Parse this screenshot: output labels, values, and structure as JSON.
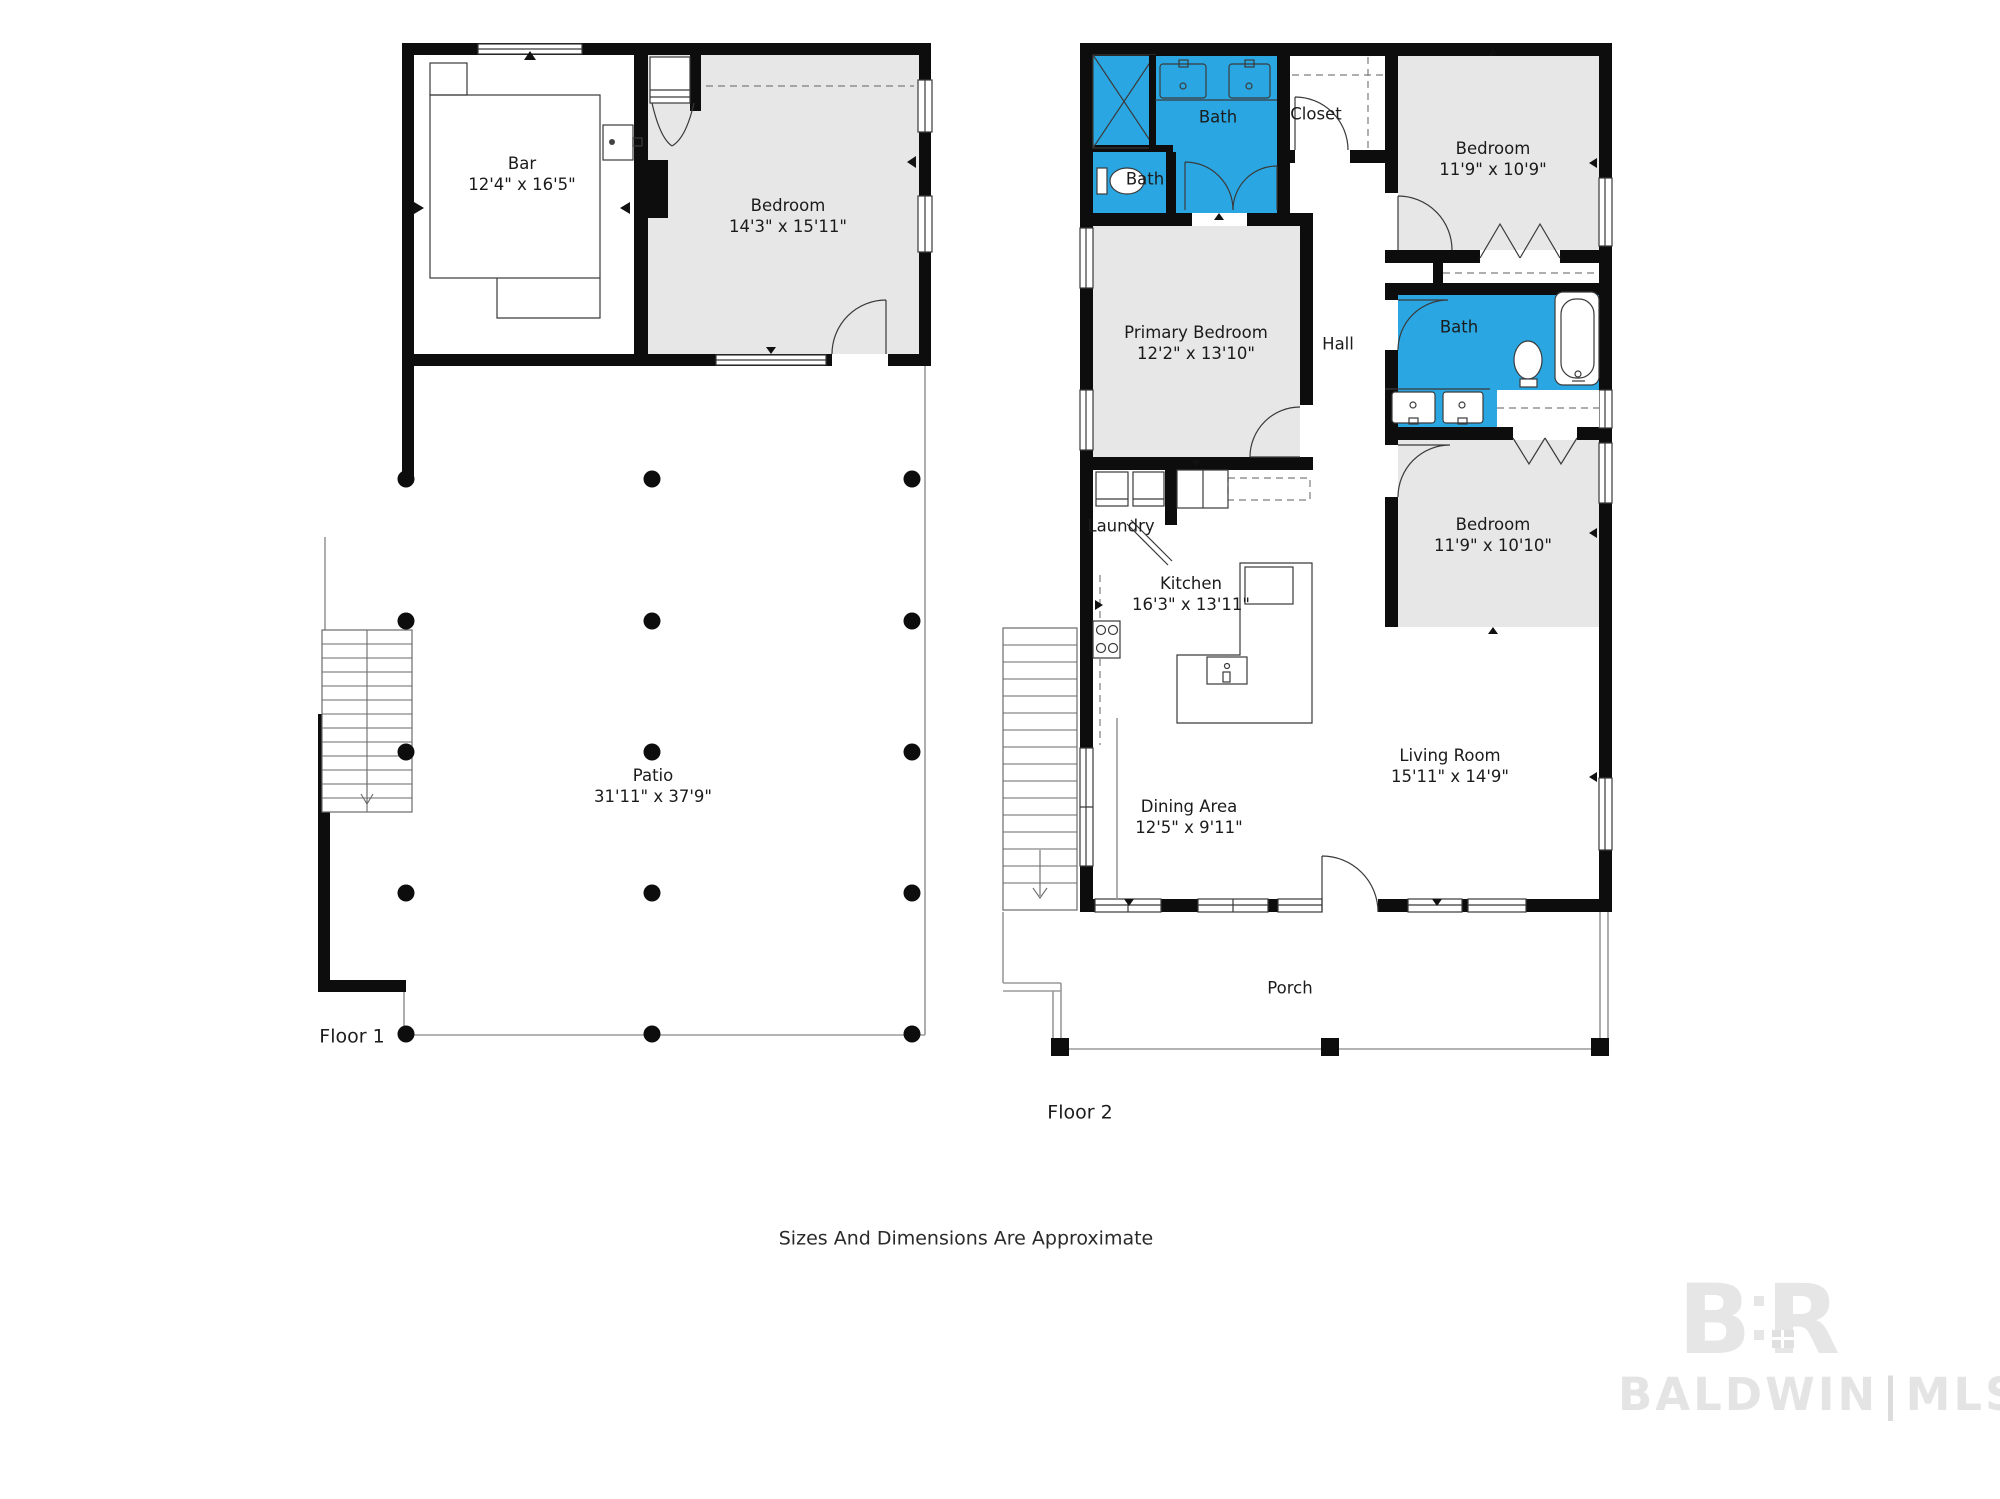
{
  "floor1": {
    "label": "Floor 1",
    "rooms": {
      "bar": {
        "name": "Bar",
        "dims": "12'4\" x 16'5\""
      },
      "bedroom": {
        "name": "Bedroom",
        "dims": "14'3\" x 15'11\""
      },
      "patio": {
        "name": "Patio",
        "dims": "31'11\" x 37'9\""
      }
    }
  },
  "floor2": {
    "label": "Floor 2",
    "rooms": {
      "bath_primary": {
        "name": "Bath"
      },
      "bath_small": {
        "name": "Bath"
      },
      "closet": {
        "name": "Closet"
      },
      "bedroom_top": {
        "name": "Bedroom",
        "dims": "11'9\" x 10'9\""
      },
      "primary_bedroom": {
        "name": "Primary Bedroom",
        "dims": "12'2\" x 13'10\""
      },
      "hall": {
        "name": "Hall"
      },
      "bath_hall": {
        "name": "Bath"
      },
      "bedroom_mid": {
        "name": "Bedroom",
        "dims": "11'9\" x 10'10\""
      },
      "laundry": {
        "name": "Laundry"
      },
      "kitchen": {
        "name": "Kitchen",
        "dims": "16'3\" x 13'11\""
      },
      "living_room": {
        "name": "Living Room",
        "dims": "15'11\" x 14'9\""
      },
      "dining_area": {
        "name": "Dining Area",
        "dims": "12'5\" x 9'11\""
      },
      "porch": {
        "name": "Porch"
      }
    }
  },
  "footer": {
    "disclaimer": "Sizes And Dimensions Are Approximate"
  },
  "watermark": {
    "logo_b": "B",
    "logo_r": "R",
    "brand": "BALDWIN",
    "divider": "|",
    "suffix": "MLS"
  },
  "colors": {
    "bath_blue": "#2aa7e2",
    "bedroom_gray": "#e7e7e7",
    "wall_black": "#0d0d0d"
  }
}
